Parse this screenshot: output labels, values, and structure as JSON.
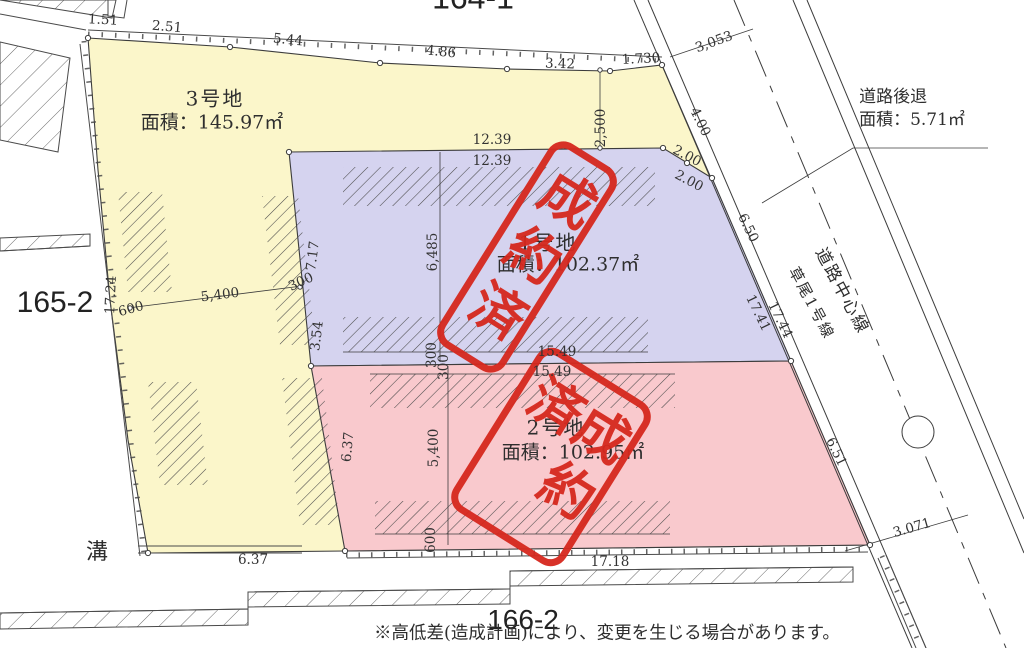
{
  "lot_numbers": {
    "top": "164-1",
    "left": "165-2",
    "bottom": "166-2"
  },
  "parcels": [
    {
      "name": "3号地",
      "area": "面積：145.97㎡"
    },
    {
      "name": "1号地",
      "area": "面積：102.37㎡",
      "status": "成約済"
    },
    {
      "name": "2号地",
      "area": "面積：102.95㎡",
      "status": "成約済"
    }
  ],
  "setback": {
    "title": "道路後退",
    "area": "面積：5.71㎡"
  },
  "road": {
    "centerline_label": "道路中心線",
    "name_label": "草尾1号線"
  },
  "labels": {
    "ditch": "溝",
    "stamp": "成約済",
    "note": "※高低差(造成計画)により、変更を生じる場合があります。"
  },
  "colors": {
    "lot1": "#d5d3ef",
    "lot2": "#f9c9cd",
    "lot3": "#fbf6ca",
    "stamp": "#d6281e",
    "line": "#3c3c3c"
  },
  "dimensions": [
    {
      "v": "1.51",
      "x": 103,
      "y": 20,
      "r": 3
    },
    {
      "v": "2.51",
      "x": 167,
      "y": 27,
      "r": 5
    },
    {
      "v": "5.44",
      "x": 288,
      "y": 40,
      "r": 6
    },
    {
      "v": "4.86",
      "x": 441,
      "y": 52,
      "r": 6
    },
    {
      "v": "3.42",
      "x": 560,
      "y": 64,
      "r": 2
    },
    {
      "v": "1.730",
      "x": 641,
      "y": 59,
      "r": -3
    },
    {
      "v": "3,053",
      "x": 714,
      "y": 42,
      "r": -20
    },
    {
      "v": "2,500",
      "x": 601,
      "y": 128,
      "r": -90
    },
    {
      "v": "12.39",
      "x": 492,
      "y": 140,
      "r": 0
    },
    {
      "v": "12.39",
      "x": 492,
      "y": 161,
      "r": 0
    },
    {
      "v": "4.00",
      "x": 700,
      "y": 122,
      "r": 64
    },
    {
      "v": "2.00",
      "x": 687,
      "y": 156,
      "r": 28
    },
    {
      "v": "2.00",
      "x": 689,
      "y": 181,
      "r": 28
    },
    {
      "v": "6.50",
      "x": 748,
      "y": 228,
      "r": 64
    },
    {
      "v": "17.41",
      "x": 758,
      "y": 313,
      "r": 64
    },
    {
      "v": "17.44",
      "x": 780,
      "y": 320,
      "r": 64
    },
    {
      "v": "6.51",
      "x": 836,
      "y": 452,
      "r": 64
    },
    {
      "v": "3.071",
      "x": 912,
      "y": 528,
      "r": -16
    },
    {
      "v": "17.18",
      "x": 610,
      "y": 562,
      "r": 0
    },
    {
      "v": "6.37",
      "x": 253,
      "y": 560,
      "r": 0
    },
    {
      "v": "6.37",
      "x": 348,
      "y": 447,
      "r": -85
    },
    {
      "v": "5,400",
      "x": 434,
      "y": 448,
      "r": -90
    },
    {
      "v": "600",
      "x": 431,
      "y": 540,
      "r": -90
    },
    {
      "v": "6,485",
      "x": 433,
      "y": 252,
      "r": -90
    },
    {
      "v": "300",
      "x": 432,
      "y": 355,
      "r": -90
    },
    {
      "v": "300",
      "x": 444,
      "y": 367,
      "r": -90
    },
    {
      "v": "15.49",
      "x": 557,
      "y": 352,
      "r": 0
    },
    {
      "v": "15.49",
      "x": 552,
      "y": 372,
      "r": 0
    },
    {
      "v": "5,400",
      "x": 220,
      "y": 295,
      "r": -7
    },
    {
      "v": "600",
      "x": 131,
      "y": 309,
      "r": -15
    },
    {
      "v": "17.24",
      "x": 111,
      "y": 295,
      "r": -87
    },
    {
      "v": "300",
      "x": 301,
      "y": 282,
      "r": -25
    },
    {
      "v": "7.17",
      "x": 313,
      "y": 256,
      "r": -83
    },
    {
      "v": "3.54",
      "x": 317,
      "y": 336,
      "r": -83
    }
  ]
}
